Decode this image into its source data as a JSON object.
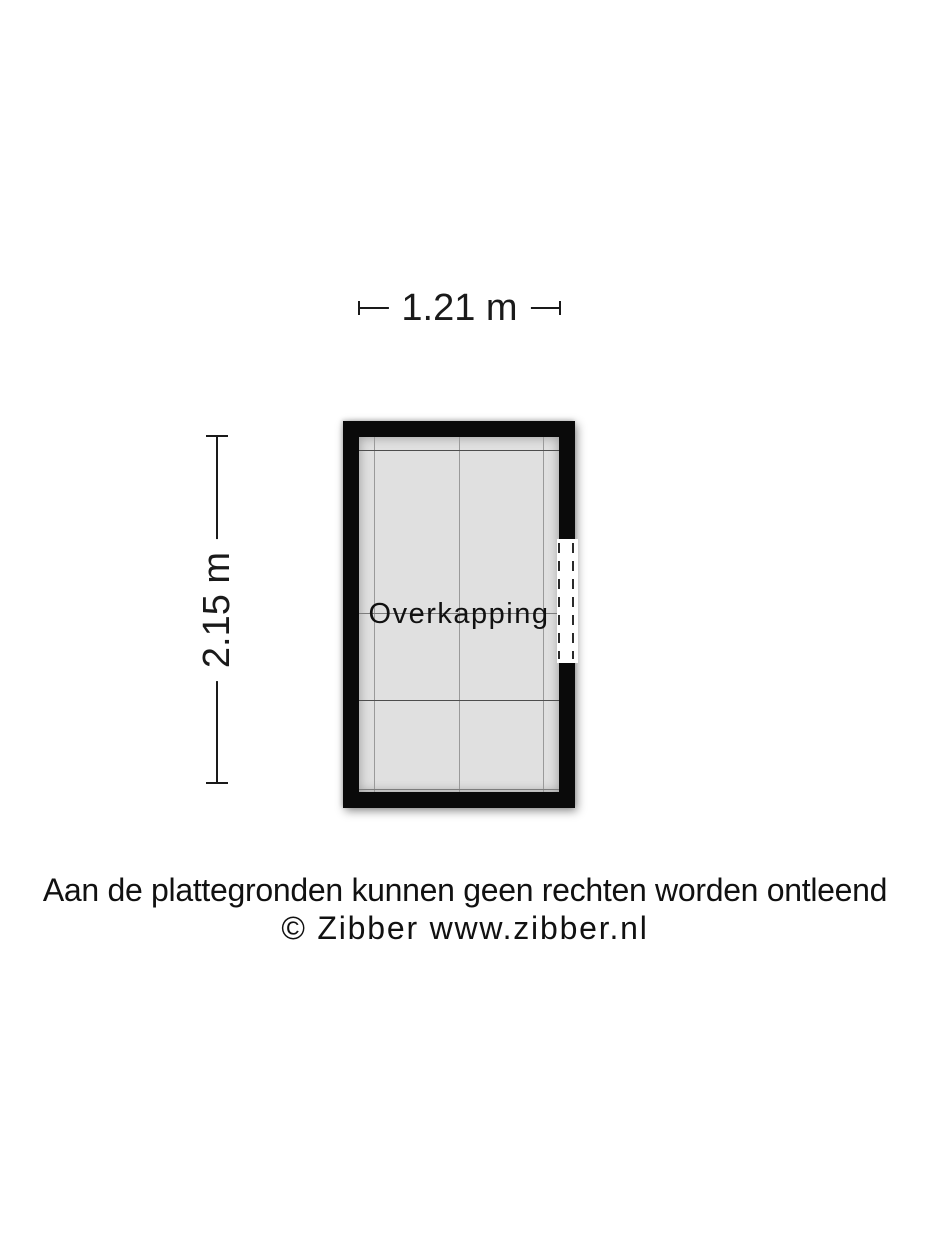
{
  "floorplan": {
    "room": {
      "label": "Overkapping"
    },
    "dimensions": {
      "width": "1.21 m",
      "height": "2.15 m"
    },
    "colors": {
      "background": "#ffffff",
      "wall": "#0a0a0a",
      "floor": "#e0e0e0",
      "grid_line_dark": "#4d4d4d",
      "grid_line_light": "#7c7c7c",
      "grid_line_vertical": "#9a9a9a",
      "dimension": "#1a1a1a",
      "opening_dash": "#2b2b2b"
    }
  },
  "footer": {
    "disclaimer": "Aan de plattegronden kunnen geen rechten worden ontleend",
    "copyright": "© Zibber www.zibber.nl"
  }
}
